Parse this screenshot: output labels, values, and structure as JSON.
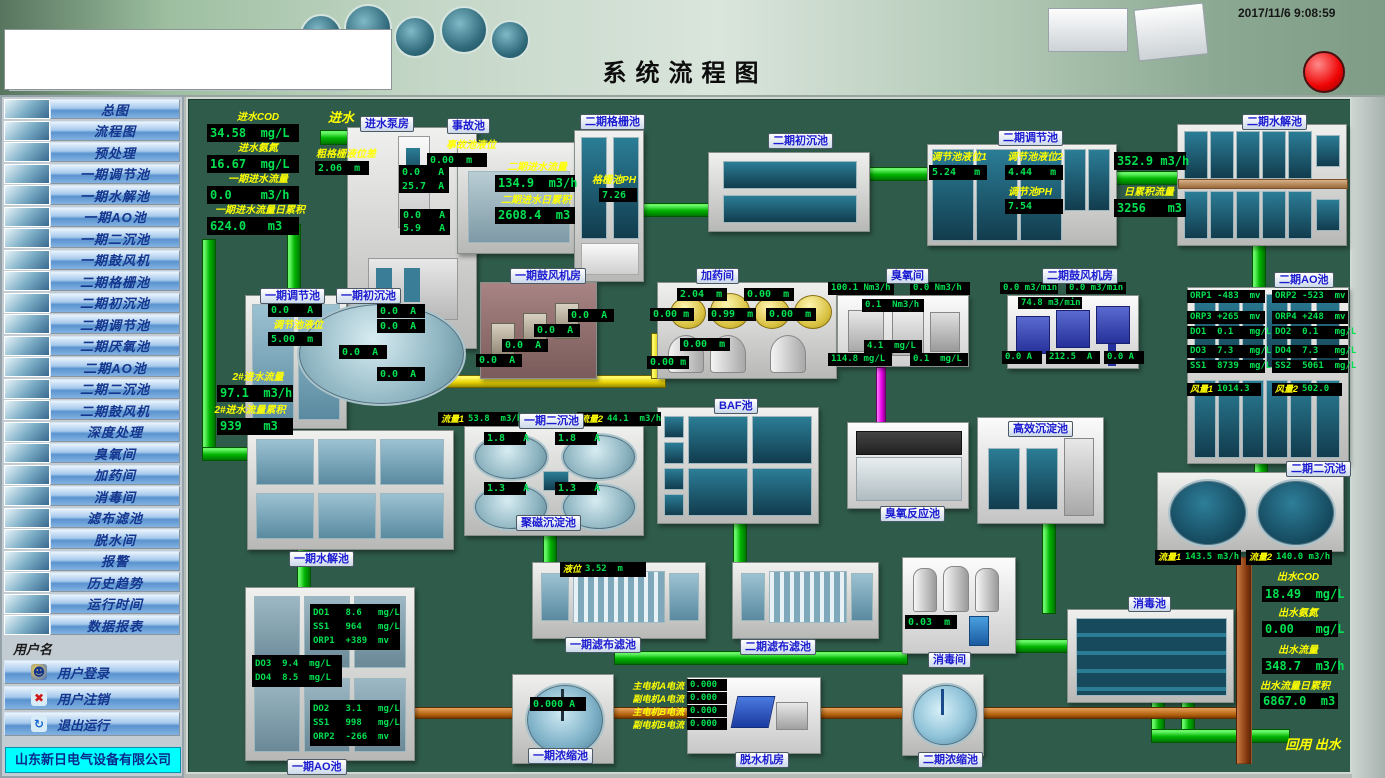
{
  "header": {
    "title": "系统流程图",
    "timestamp": "2017/11/6 9:08:59"
  },
  "sidebar": {
    "items": [
      "总图",
      "流程图",
      "预处理",
      "一期调节池",
      "一期水解池",
      "一期AO池",
      "一期二沉池",
      "一期鼓风机",
      "二期格栅池",
      "二期初沉池",
      "二期调节池",
      "二期厌氧池",
      "二期AO池",
      "二期二沉池",
      "二期鼓风机",
      "深度处理",
      "臭氧间",
      "加药间",
      "消毒间",
      "滤布滤池",
      "脱水间",
      "报警",
      "历史趋势",
      "运行时间",
      "数据报表"
    ],
    "username_label": "用户名",
    "login": "用户登录",
    "logout": "用户注销",
    "exit": "退出运行",
    "company": "山东新日电气设备有限公司"
  },
  "colors": {
    "canvas": "#2f5b4b",
    "led_green": "#00e050",
    "label_yellow": "#ffff00",
    "pipe_green": "#00b400",
    "pipe_yellow": "#e5cf00",
    "pipe_magenta": "#e400e4",
    "pipe_orange": "#b05e0a",
    "alarm_red": "#ee0404"
  },
  "main": {
    "influent": {
      "inflow_label": "进水",
      "cod_l": "进水COD",
      "cod": "34.58  mg/L",
      "nh3_l": "进水氨氮",
      "nh3": "16.67  mg/L",
      "f1_l": "一期进水流量",
      "f1": "0.0    m3/h",
      "f1t_l": "一期进水流量日累积",
      "f1t": "624.0   m3"
    },
    "pump_house": {
      "plate": "进水泵房",
      "screen_l": "粗格栅液位差",
      "screen": "2.06  m",
      "amps": [
        "0.0   A",
        "25.7  A",
        "0.0   A",
        "5.9   A"
      ]
    },
    "accident": {
      "plate": "事故池",
      "lvl_l": "事故池液位",
      "lvl": "0.00  m"
    },
    "grid2": {
      "plate": "二期格栅池",
      "ph_l": "格栅池PH",
      "ph": "7.26",
      "f_l": "二期进水流量",
      "f": "134.9  m3/h",
      "ft_l": "二期进水日累积",
      "ft": "2608.4  m3"
    },
    "sed2_1": {
      "plate": "二期初沉池"
    },
    "reg2": {
      "plate": "二期调节池",
      "l1_l": "调节池液位1",
      "l1": "5.24   m",
      "l2_l": "调节池液位2",
      "l2": "4.44   m",
      "ph_l": "调节池PH",
      "ph": "7.54",
      "f": "352.9 m3/h",
      "ft_l": "日累积流量",
      "ft": "3256   m3"
    },
    "hyd2": {
      "plate": "二期水解池"
    },
    "reg1": {
      "plate": "一期调节池",
      "a": "0.0   A",
      "lvl_l": "调节池液位",
      "lvl": "5.00  m"
    },
    "sed1_1": {
      "plate": "一期初沉池",
      "amps": [
        "0.0  A",
        "0.0  A",
        "0.0  A",
        "0.0  A"
      ]
    },
    "flow2": {
      "f_l": "2#进水流量",
      "f": "97.1  m3/h",
      "ft_l": "2#进水流量累积",
      "ft": "939   m3"
    },
    "blower1": {
      "plate": "一期鼓风机房",
      "amps": [
        "0.0  A",
        "0.0  A",
        "0.0  A",
        "0.0  A"
      ]
    },
    "dosing": {
      "plate": "加药间",
      "levels": [
        "2.04  m",
        "0.00  m",
        "0.00 m",
        "0.99  m",
        "0.00  m",
        "0.00  m",
        "0.00 m"
      ]
    },
    "ozone": {
      "plate": "臭氧间",
      "vals": [
        "100.1 Nm3/h",
        "0.0 Nm3/h",
        "0.1  Nm3/h",
        "4.1  mg/L",
        "114.8 mg/L",
        "0.1  mg/L"
      ]
    },
    "blower2": {
      "plate": "二期鼓风机房",
      "flows": [
        "0.0 m3/min",
        "0.0 m3/min",
        "74.8 m3/min"
      ],
      "amps": [
        "0.0 A",
        "212.5  A",
        "0.0 A"
      ]
    },
    "ao2": {
      "plate": "二期AO池",
      "left": [
        "ORP1 -483  mv",
        "ORP3 +265  mv",
        "DO1  0.1   mg/L",
        "DO3  7.3   mg/L",
        "SS1  8739  mg/L"
      ],
      "fan1_l": "风量1",
      "fan1": "1014.3",
      "right": [
        "ORP2 -523  mv",
        "ORP4 +248  mv",
        "DO2  0.1   mg/L",
        "DO4  7.3   mg/L",
        "SS2  5061  mg/L"
      ],
      "fan2_l": "风量2",
      "fan2": "502.0"
    },
    "hyd1": {
      "plate": "一期水解池"
    },
    "sed1_2": {
      "plate": "一期二沉池",
      "plate2": "聚磁沉淀池",
      "f1_l": "流量1",
      "f1": "53.8  m3/h",
      "f2_l": "流量2",
      "f2": "44.1  m3/h",
      "amps": [
        "1.8   A",
        "1.8   A",
        "1.3   A",
        "1.3   A"
      ]
    },
    "baf": {
      "plate": "BAF池"
    },
    "ozone_pool": {
      "plate": "臭氧反应池"
    },
    "hes": {
      "plate": "高效沉淀池"
    },
    "sed2_2": {
      "plate": "二期二沉池",
      "f1_l": "流量1",
      "f1": "143.5 m3/h",
      "f2_l": "流量2",
      "f2": "140.0 m3/h"
    },
    "ao1": {
      "plate": "一期AO池",
      "top": [
        "DO1   8.6   mg/L",
        "SS1   964   mg/L",
        "ORP1  +389  mv"
      ],
      "mid": [
        "DO3  9.4  mg/L",
        "DO4  8.5  mg/L"
      ],
      "bottom": [
        "DO2   3.1   mg/L",
        "SS1   998   mg/L",
        "ORP2  -266  mv"
      ]
    },
    "filter1": {
      "plate": "一期滤布滤池",
      "lvl_l": "液位",
      "lvl": "3.52  m"
    },
    "filter2": {
      "plate": "二期滤布滤池"
    },
    "disinfect_room": {
      "plate": "消毒间",
      "v": "0.03  m"
    },
    "disinfect_pool": {
      "plate": "消毒池"
    },
    "thick1": {
      "plate": "一期浓缩池",
      "a": "0.000 A"
    },
    "dewater": {
      "plate": "脱水机房",
      "motors": [
        {
          "l": "主电机A电流",
          "v": "0.000"
        },
        {
          "l": "副电机A电流",
          "v": "0.000"
        },
        {
          "l": "主电机B电流",
          "v": "0.000"
        },
        {
          "l": "副电机B电流",
          "v": "0.000"
        }
      ]
    },
    "thick2": {
      "plate": "二期浓缩池"
    },
    "effluent": {
      "cod_l": "出水COD",
      "cod": "18.49  mg/L",
      "nh3_l": "出水氨氮",
      "nh3": "0.00   mg/L",
      "f_l": "出水流量",
      "f": "348.7  m3/h",
      "ft_l": "出水流量日累积",
      "ft": "6867.0  m3",
      "reuse": "回用   出水"
    }
  }
}
